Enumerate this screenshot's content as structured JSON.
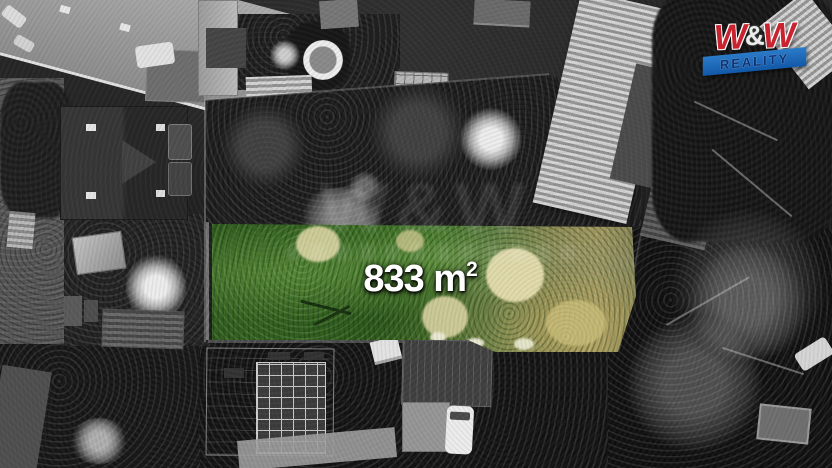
{
  "scene": {
    "area_label": {
      "value": "833 m",
      "superscript": "2"
    }
  },
  "logo": {
    "title_left": "W",
    "ampersand": "&",
    "title_right": "W",
    "subtitle": "REALITY",
    "colors": {
      "title_red": "#c8232e",
      "ribbon_blue": "#1a65b4",
      "subtitle_navy": "#0d3273",
      "outline_white": "#ffffff"
    }
  },
  "watermark": {
    "letters": "W&W"
  },
  "colors": {
    "plot_highlight_green": "#3c6e26",
    "dry_grass_tan": "#a89a60",
    "photo_tone": "#262626"
  }
}
